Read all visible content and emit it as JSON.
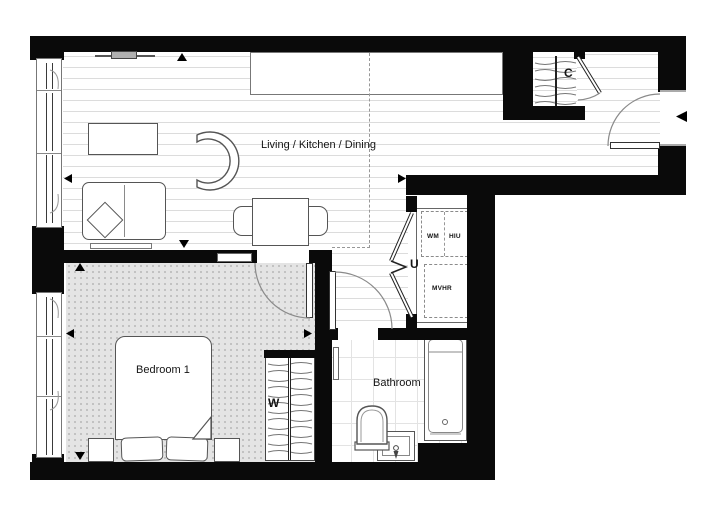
{
  "floorplan": {
    "rooms": {
      "living": "Living / Kitchen / Dining",
      "bedroom": "Bedroom 1",
      "bathroom": "Bathroom"
    },
    "closets": {
      "hall_cupboard": "C",
      "utility_cupboard": "U",
      "wardrobe": "W"
    },
    "equipment": {
      "washing_machine": "WM",
      "heat_interface_unit": "HIU",
      "ventilation_unit": "MVHR"
    },
    "colors": {
      "wall": "#0a0a0a",
      "carpet": "#e4e4e4",
      "plank_line": "#dcdcdc",
      "tile_line": "#e3e3e3",
      "furniture_outline": "#555555"
    }
  }
}
